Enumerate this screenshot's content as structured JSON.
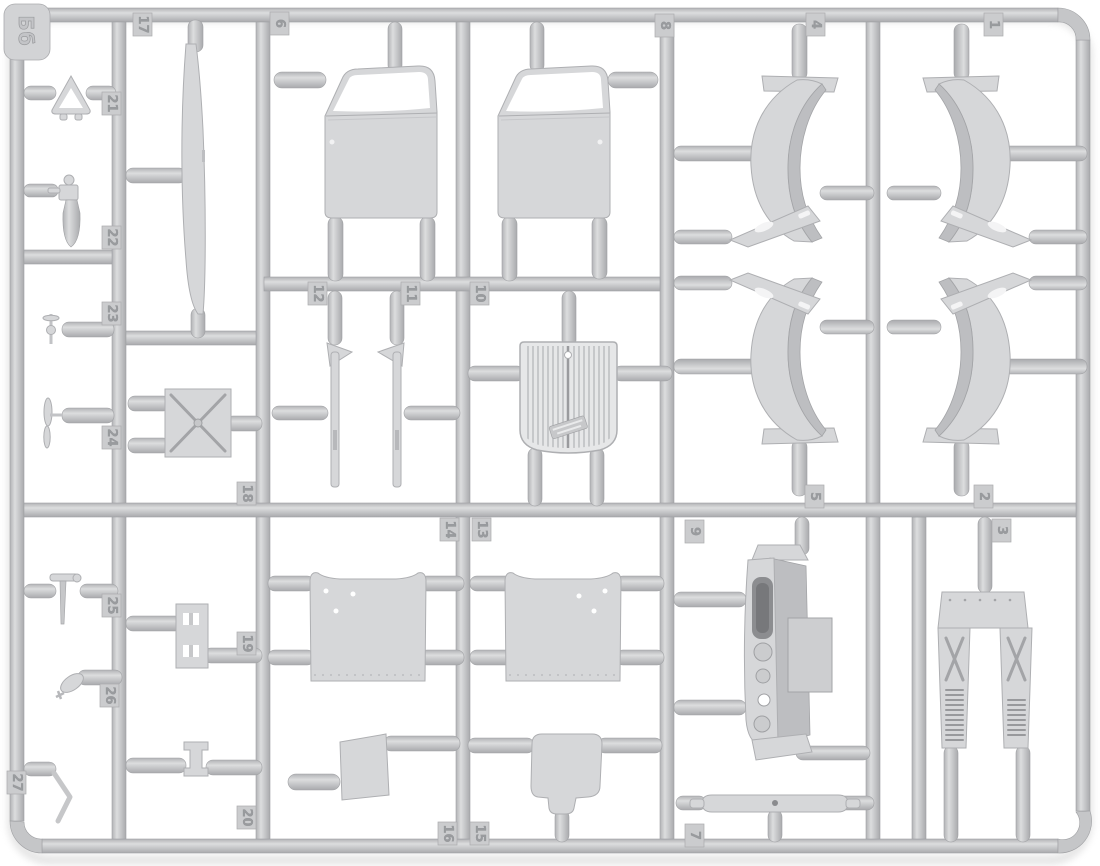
{
  "sprue": {
    "letter": "Бб",
    "description": "model-kit-sprue-frame"
  },
  "colors": {
    "background": "#ffffff",
    "plastic": "#c9cacc",
    "plastic_highlight": "#dcddde",
    "plastic_shadow": "#a9aaad",
    "part_fill": "#d6d7d9",
    "tag_number": "#999b9e"
  },
  "parts": [
    {
      "label": "1",
      "shape": "front-fender"
    },
    {
      "label": "2",
      "shape": "rear-fender"
    },
    {
      "label": "3",
      "shape": "hood-side-panels"
    },
    {
      "label": "4",
      "shape": "front-fender"
    },
    {
      "label": "5",
      "shape": "rear-fender"
    },
    {
      "label": "6",
      "shape": "cab-door"
    },
    {
      "label": "7",
      "shape": "linkage-bar"
    },
    {
      "label": "8",
      "shape": "cab-door"
    },
    {
      "label": "9",
      "shape": "firewall-dashboard"
    },
    {
      "label": "10",
      "shape": "radiator-grille"
    },
    {
      "label": "11",
      "shape": "lever-arm"
    },
    {
      "label": "12",
      "shape": "lever-arm"
    },
    {
      "label": "13",
      "shape": "cab-panel"
    },
    {
      "label": "14",
      "shape": "cab-panel"
    },
    {
      "label": "15",
      "shape": "seat-base"
    },
    {
      "label": "16",
      "shape": "floor-panel"
    },
    {
      "label": "17",
      "shape": "trim-strip"
    },
    {
      "label": "18",
      "shape": "cross-braced-plate"
    },
    {
      "label": "19",
      "shape": "bracket-plate"
    },
    {
      "label": "20",
      "shape": "small-bracket"
    },
    {
      "label": "21",
      "shape": "emblem-triangle"
    },
    {
      "label": "22",
      "shape": "fuel-pump"
    },
    {
      "label": "23",
      "shape": "filler-cap"
    },
    {
      "label": "24",
      "shape": "hood-ornament"
    },
    {
      "label": "25",
      "shape": "control-lever"
    },
    {
      "label": "26",
      "shape": "horn"
    },
    {
      "label": "27",
      "shape": "pedal-lever"
    }
  ]
}
